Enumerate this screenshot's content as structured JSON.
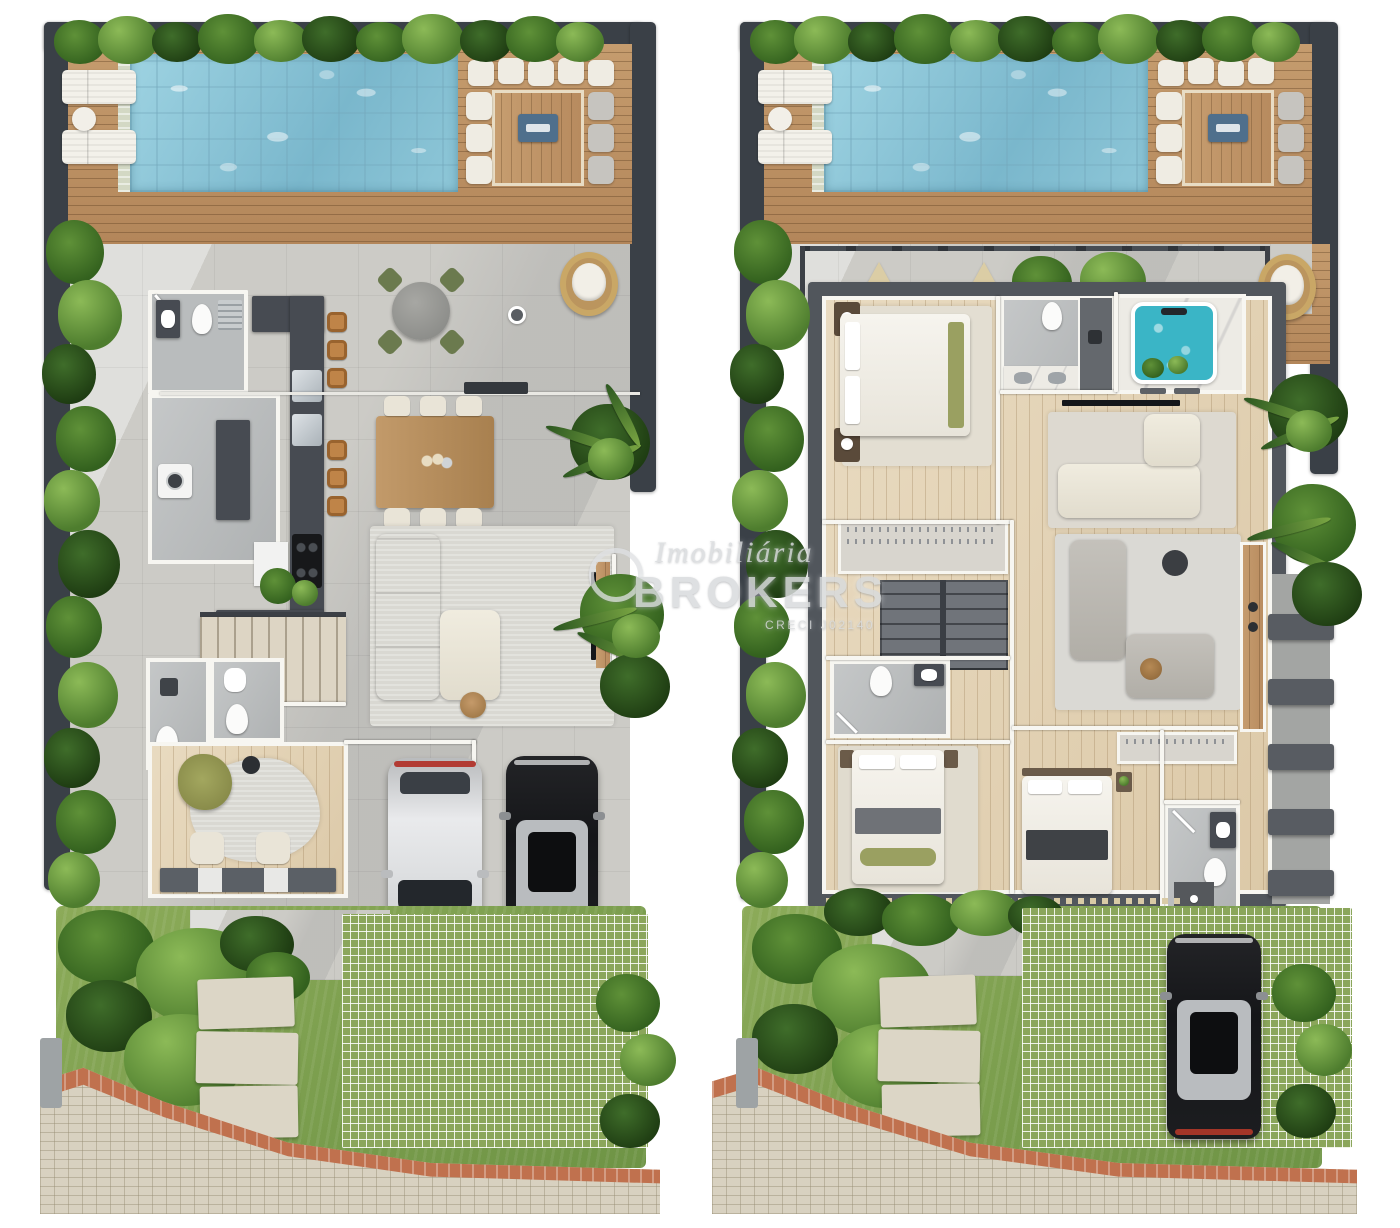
{
  "watermark": {
    "script": "Imobiliária",
    "name": "BROKERS",
    "registry": "CRECI J02140"
  },
  "panels": [
    {
      "name": "floor-plan-ground"
    },
    {
      "name": "floor-plan-upper"
    }
  ],
  "palette": {
    "wall": "#3a4047",
    "deck_wood": "#b98a5c",
    "pool_water": "#83c0d4",
    "patio": "#cccbc6",
    "interior_wood": "#e4d5ba",
    "grass": "#7ea14d",
    "paver_grid": "#8ba65b",
    "sidewalk": "#d8d1c0",
    "brick_stripe": "#c0714e",
    "counter_dark": "#474b52",
    "sofa_cream": "#ece7dc",
    "sofa_gray": "#bdbab4",
    "car_white": "#dfe0e2",
    "car_black": "#1a1b1e",
    "jacuzzi": "#3ab5c6",
    "plant_dark": "#2e5526",
    "plant_light": "#7fae4c"
  }
}
